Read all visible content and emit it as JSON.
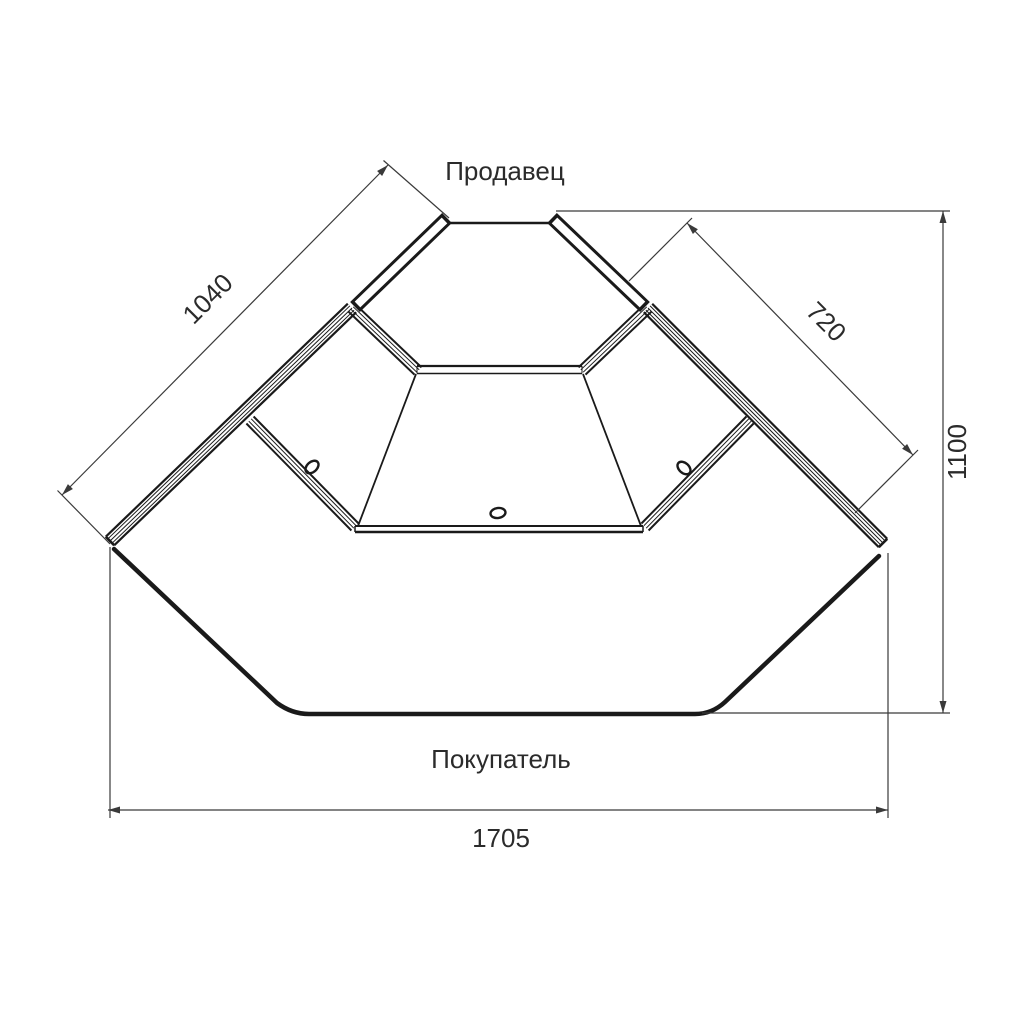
{
  "drawing": {
    "labels": {
      "seller_side": "Продавец",
      "buyer_side": "Покупатель"
    },
    "dimensions": {
      "left_glass_length": "1040",
      "right_glass_length": "720",
      "overall_depth": "1100",
      "overall_front_width": "1705"
    },
    "colors": {
      "outline": "#1a1a1a",
      "dimension_lines": "#3a3a3a",
      "text": "#2b2b2b",
      "background": "#ffffff"
    }
  }
}
